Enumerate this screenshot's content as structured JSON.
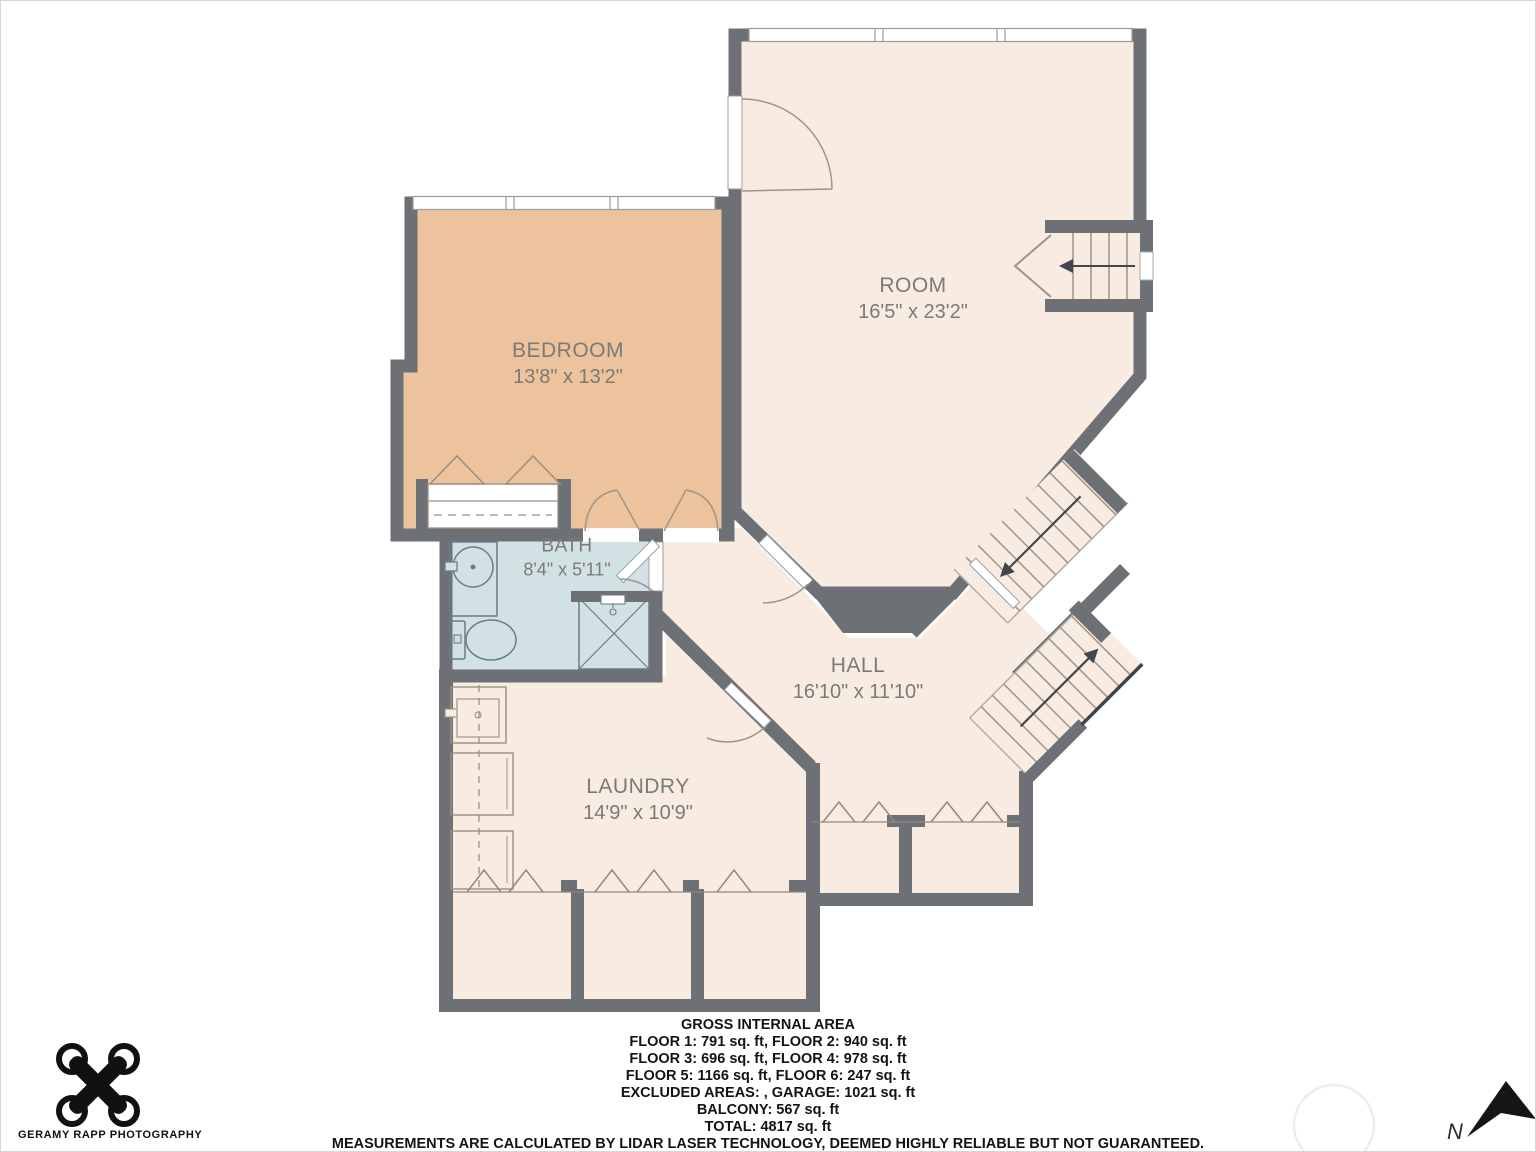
{
  "plan": {
    "rooms": [
      {
        "name": "ROOM",
        "dimensions": "16'5\" x 23'2\""
      },
      {
        "name": "BEDROOM",
        "dimensions": "13'8\" x 13'2\""
      },
      {
        "name": "BATH",
        "dimensions": "8'4\" x 5'11\""
      },
      {
        "name": "HALL",
        "dimensions": "16'10\" x 11'10\""
      },
      {
        "name": "LAUNDRY",
        "dimensions": "14'9\" x 10'9\""
      }
    ],
    "colors": {
      "wall": "#6d7176",
      "floor": "#f8ece2",
      "bedroom_floor": "#edc39e",
      "bath_floor": "#d2e2e4",
      "fixture_line": "#9b8f80"
    },
    "compass_label": "N"
  },
  "footer": {
    "title": "GROSS INTERNAL AREA",
    "lines": [
      "FLOOR 1: 791 sq. ft, FLOOR 2: 940 sq. ft",
      "FLOOR 3: 696 sq. ft, FLOOR 4: 978 sq. ft",
      "FLOOR 5: 1166 sq. ft, FLOOR 6: 247 sq. ft",
      "EXCLUDED AREAS: , GARAGE: 1021 sq. ft",
      "BALCONY: 567 sq. ft",
      "TOTAL: 4817 sq. ft"
    ],
    "disclaimer": "MEASUREMENTS ARE CALCULATED BY LIDAR LASER TECHNOLOGY, DEEMED HIGHLY RELIABLE BUT NOT GUARANTEED."
  },
  "branding": {
    "photographer": "GERAMY RAPP PHOTOGRAPHY"
  }
}
